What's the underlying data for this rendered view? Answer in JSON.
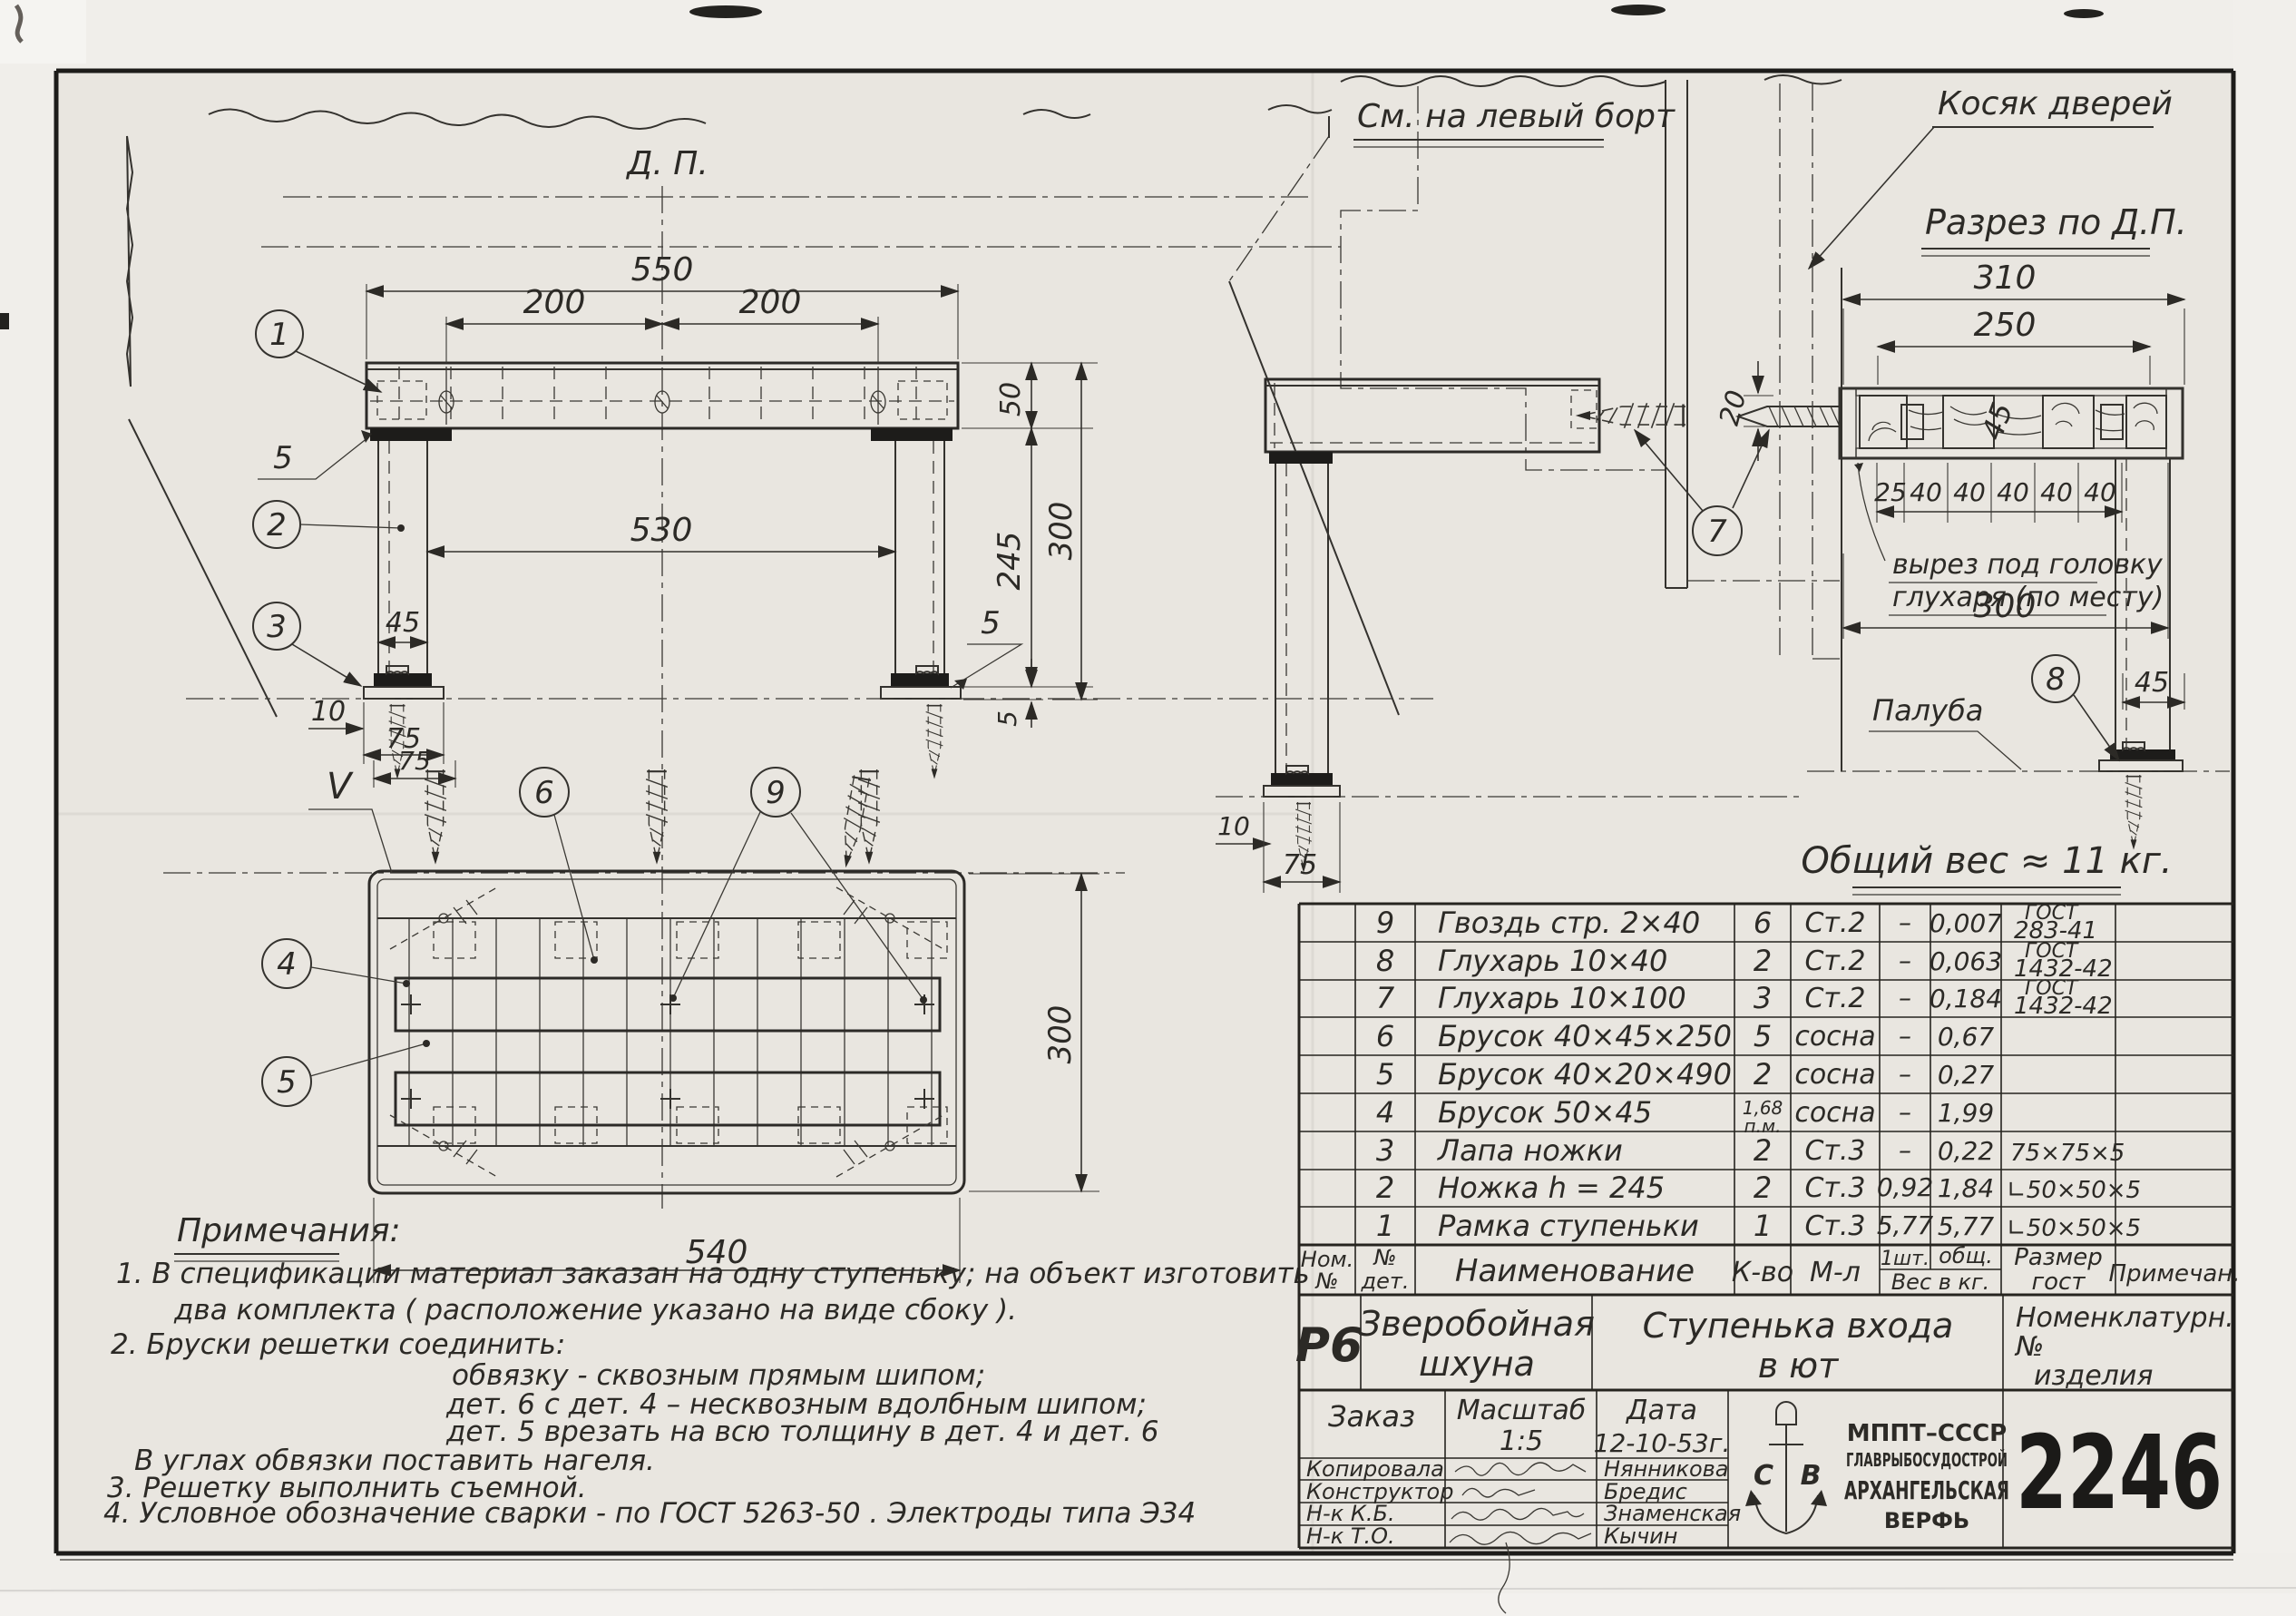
{
  "colors": {
    "paper": "#eceae5",
    "paper_inner": "#e9e6e0",
    "margin": "#f0eeea",
    "ink": "#2c2a26",
    "ink_dark": "#1d1c1a"
  },
  "labels": {
    "dp": "Д. П.",
    "see_left_board": "См. на левый борт",
    "door_jamb": "Косяк дверей",
    "section_title": "Разрез по Д.П.",
    "cutout_line1": "вырез под головку",
    "cutout_line2": "глухаря (по месту)",
    "deck": "Палуба",
    "total_weight": "Общий вес ≈ 11 кг.",
    "v_mark": "V"
  },
  "callouts": {
    "c1": "1",
    "c2": "2",
    "c3": "3",
    "c4": "4",
    "c5": "5",
    "c6": "6",
    "c7": "7",
    "c8": "8",
    "c9": "9"
  },
  "dims": {
    "front": {
      "total": "550",
      "left": "200",
      "right": "200",
      "height": "50",
      "inner": "530",
      "leg": "245",
      "overall": "300",
      "leg_w": "45",
      "pad": "5",
      "pad2": "5",
      "gap": "5",
      "off": "10",
      "base": "75"
    },
    "side": {
      "gap": "20",
      "off": "10",
      "base": "75"
    },
    "plan": {
      "width": "540",
      "depth": "300",
      "off": "75"
    },
    "section": {
      "width": "310",
      "inner": "250",
      "thick": "45",
      "segs": [
        "25",
        "40",
        "40",
        "40",
        "40",
        "40"
      ],
      "span": "300",
      "leg": "45"
    }
  },
  "spec": {
    "header": {
      "nom_l1": "Ном.",
      "nom_l2": "№",
      "det_l1": "№",
      "det_l2": "дет.",
      "name": "Наименование",
      "qty": "К-во",
      "mat": "М-л",
      "w1": "1шт.",
      "w2": "общ.",
      "w_sub": "Вес в кг.",
      "size_l1": "Размер",
      "size_l2": "гост",
      "note": "Примечан."
    },
    "rows": [
      {
        "det": "9",
        "name": "Гвоздь стр.  2×40",
        "qty": "6",
        "qty2": "",
        "mat": "Ст.2",
        "w1": "–",
        "w2": "0,007",
        "size1": "ГОСТ",
        "size2": "283-41",
        "note": ""
      },
      {
        "det": "8",
        "name": "Глухарь   10×40",
        "qty": "2",
        "qty2": "",
        "mat": "Ст.2",
        "w1": "–",
        "w2": "0,063",
        "size1": "ГОСТ",
        "size2": "1432-42",
        "note": ""
      },
      {
        "det": "7",
        "name": "Глухарь   10×100",
        "qty": "3",
        "qty2": "",
        "mat": "Ст.2",
        "w1": "–",
        "w2": "0,184",
        "size1": "ГОСТ",
        "size2": "1432-42",
        "note": ""
      },
      {
        "det": "6",
        "name": "Брусок   40×45×250",
        "qty": "5",
        "qty2": "",
        "mat": "сосна",
        "w1": "–",
        "w2": "0,67",
        "size1": "",
        "size2": "",
        "note": ""
      },
      {
        "det": "5",
        "name": "Брусок   40×20×490",
        "qty": "2",
        "qty2": "",
        "mat": "сосна",
        "w1": "–",
        "w2": "0,27",
        "size1": "",
        "size2": "",
        "note": ""
      },
      {
        "det": "4",
        "name": "Брусок   50×45",
        "qty": "1,68",
        "qty2": "п.м.",
        "mat": "сосна",
        "w1": "–",
        "w2": "1,99",
        "size1": "",
        "size2": "",
        "note": ""
      },
      {
        "det": "3",
        "name": "Лапа ножки",
        "qty": "2",
        "qty2": "",
        "mat": "Ст.3",
        "w1": "–",
        "w2": "0,22",
        "size1": "",
        "size2": "75×75×5",
        "note": ""
      },
      {
        "det": "2",
        "name": "Ножка  h = 245",
        "qty": "2",
        "qty2": "",
        "mat": "Ст.3",
        "w1": "0,92",
        "w2": "1,84",
        "size1": "",
        "size2": "∟50×50×5",
        "note": ""
      },
      {
        "det": "1",
        "name": "Рамка ступеньки",
        "qty": "1",
        "qty2": "",
        "mat": "Ст.3",
        "w1": "5,77",
        "w2": "5,77",
        "size1": "",
        "size2": "∟50×50×5",
        "note": ""
      }
    ]
  },
  "titleblock": {
    "series": "Р6",
    "object_l1": "Зверобойная",
    "object_l2": "шхуна",
    "part_l1": "Ступенька входа",
    "part_l2": "в ют",
    "nomen_l1": "Номенклатурн.",
    "nomen_l2": "№",
    "nomen_l3": "изделия",
    "order_label": "Заказ",
    "scale_label": "Масштаб",
    "scale_value": "1:5",
    "date_label": "Дата",
    "date_value": "12-10-53г.",
    "signatures": [
      {
        "role": "Копировала",
        "name": "Нянникова"
      },
      {
        "role": "Конструктор",
        "name": "Бредис"
      },
      {
        "role": "Н-к  К.Б.",
        "name": "Знаменская"
      },
      {
        "role": "Н-к  Т.О.",
        "name": "Кычин"
      }
    ],
    "org_l1": "МППТ–СССР",
    "org_l2": "ГЛАВРЫБОСУДОСТРОЙ",
    "org_l3": "АРХАНГЕЛЬСКАЯ",
    "org_l4": "ВЕРФЬ",
    "logo_l": "С",
    "logo_r": "В",
    "number": "2246"
  },
  "notes": {
    "title": "Примечания:",
    "n1a": "1. В спецификации  материал  заказан  на одну  ступеньку;  на объект  изготовить",
    "n1b": "два  комплекта  ( расположение  указано  на  виде  сбоку ).",
    "n2": "2. Бруски  решетки  соединить:",
    "n2a": "обвязку - сквозным  прямым  шипом;",
    "n2b": "дет. 6  с  дет. 4 – несквозным  вдолбным  шипом;",
    "n2c": "дет. 5  врезать  на  всю  толщину   в дет. 4 и дет. 6",
    "n2d": "В углах  обвязки   поставить  нагеля.",
    "n3": "3. Решетку    выполнить  съемной.",
    "n4": "4. Условное   обозначение   сварки - по   ГОСТ  5263-50 . Электроды  типа  Э34"
  }
}
